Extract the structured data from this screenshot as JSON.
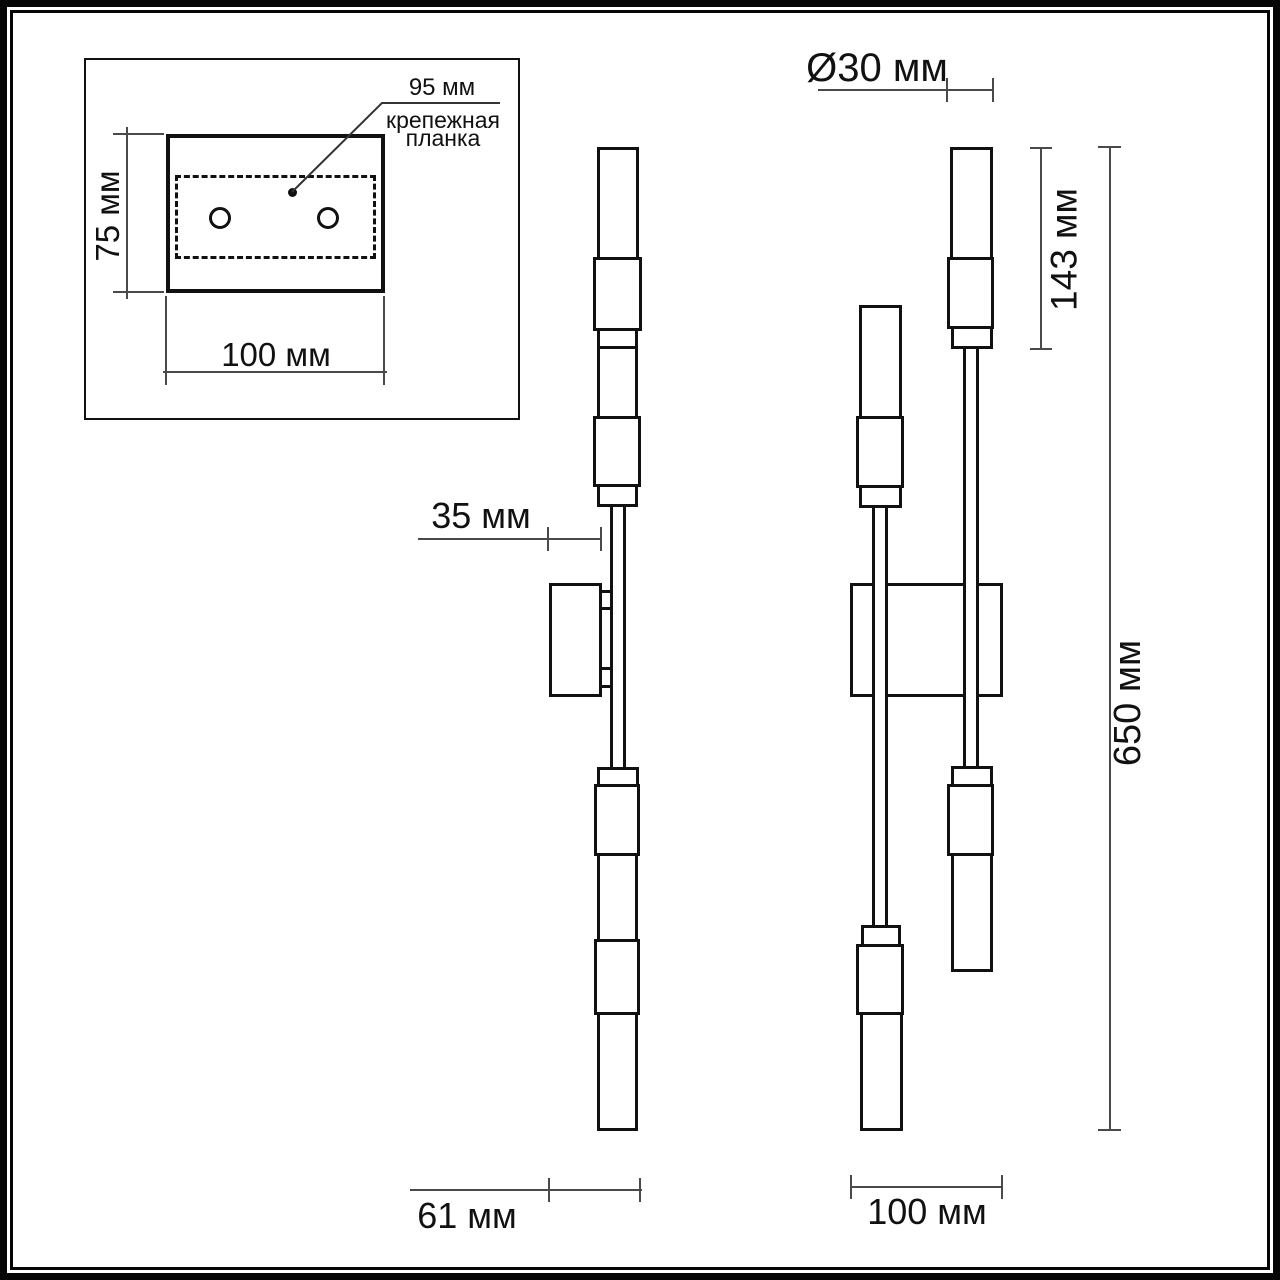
{
  "inset": {
    "plate_spacing_label": "95 мм",
    "plate_caption_lines": [
      "крепежная",
      "планка"
    ],
    "plate_height_label": "75 мм",
    "plate_width_label": "100 мм"
  },
  "side_view": {
    "box_depth_label": "35 мм",
    "total_depth_label": "61 мм"
  },
  "front_view": {
    "tube_diameter_label": "Ø30 мм",
    "shade_height_label": "143 мм",
    "total_height_label": "650 мм",
    "box_width_label": "100 мм"
  },
  "colors": {
    "outline": "#111111",
    "dimension_line": "#4a4a4a",
    "background": "#ffffff"
  }
}
